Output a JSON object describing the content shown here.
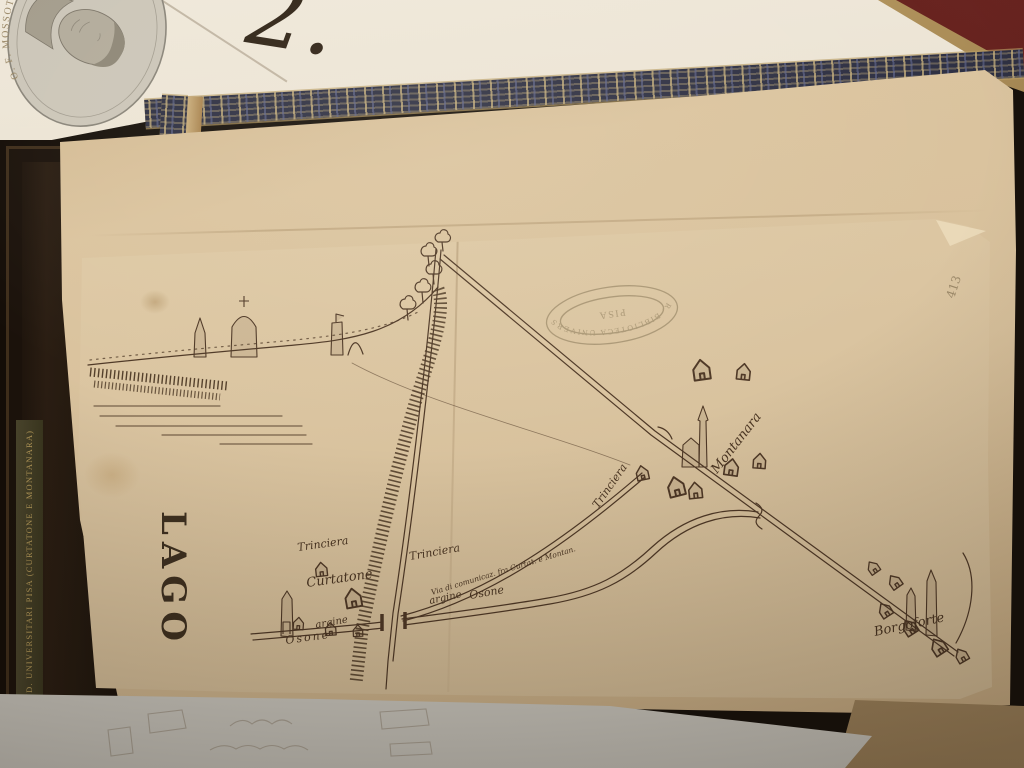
{
  "photo": {
    "medallion_caption": "O. F. MOSSOTTI",
    "loose_sheet_numeral": "2.",
    "spine_label": "COCCARDA STUD. UNIVERSITARI PISA (CURTATONE E MONTANARA)"
  },
  "map": {
    "page_number": "413",
    "stamp": {
      "arc_text": "R. BIBLIOTECA UNIVERSITARIA",
      "center_text": "PISA"
    },
    "labels": {
      "lago": "LAGO",
      "trinciera_left": "Trinciera",
      "trinciera_mid": "Trinciera",
      "trinciera_montanara": "Trinciera",
      "curtatone": "Curtatone",
      "montanara": "Montanara",
      "borgoforte": "Borgoforte",
      "argine_west": "argine",
      "osone_west": "Osone",
      "argine_east": "argine",
      "osone_east": "Osone",
      "via_comunicazione": "Via di comunicaz. fra Curtat. e Montan."
    }
  },
  "colors": {
    "ink": "#4e3826",
    "map_paper": "#dcc8a6",
    "outer_paper": "#d2ba92",
    "white_sheet": "#e7e0d2",
    "bottom_sheet": "#dbd8d0",
    "cover_band": "#2e3043",
    "maroon_cover": "#5c1f1b",
    "spine_gold": "#b59a5a"
  }
}
